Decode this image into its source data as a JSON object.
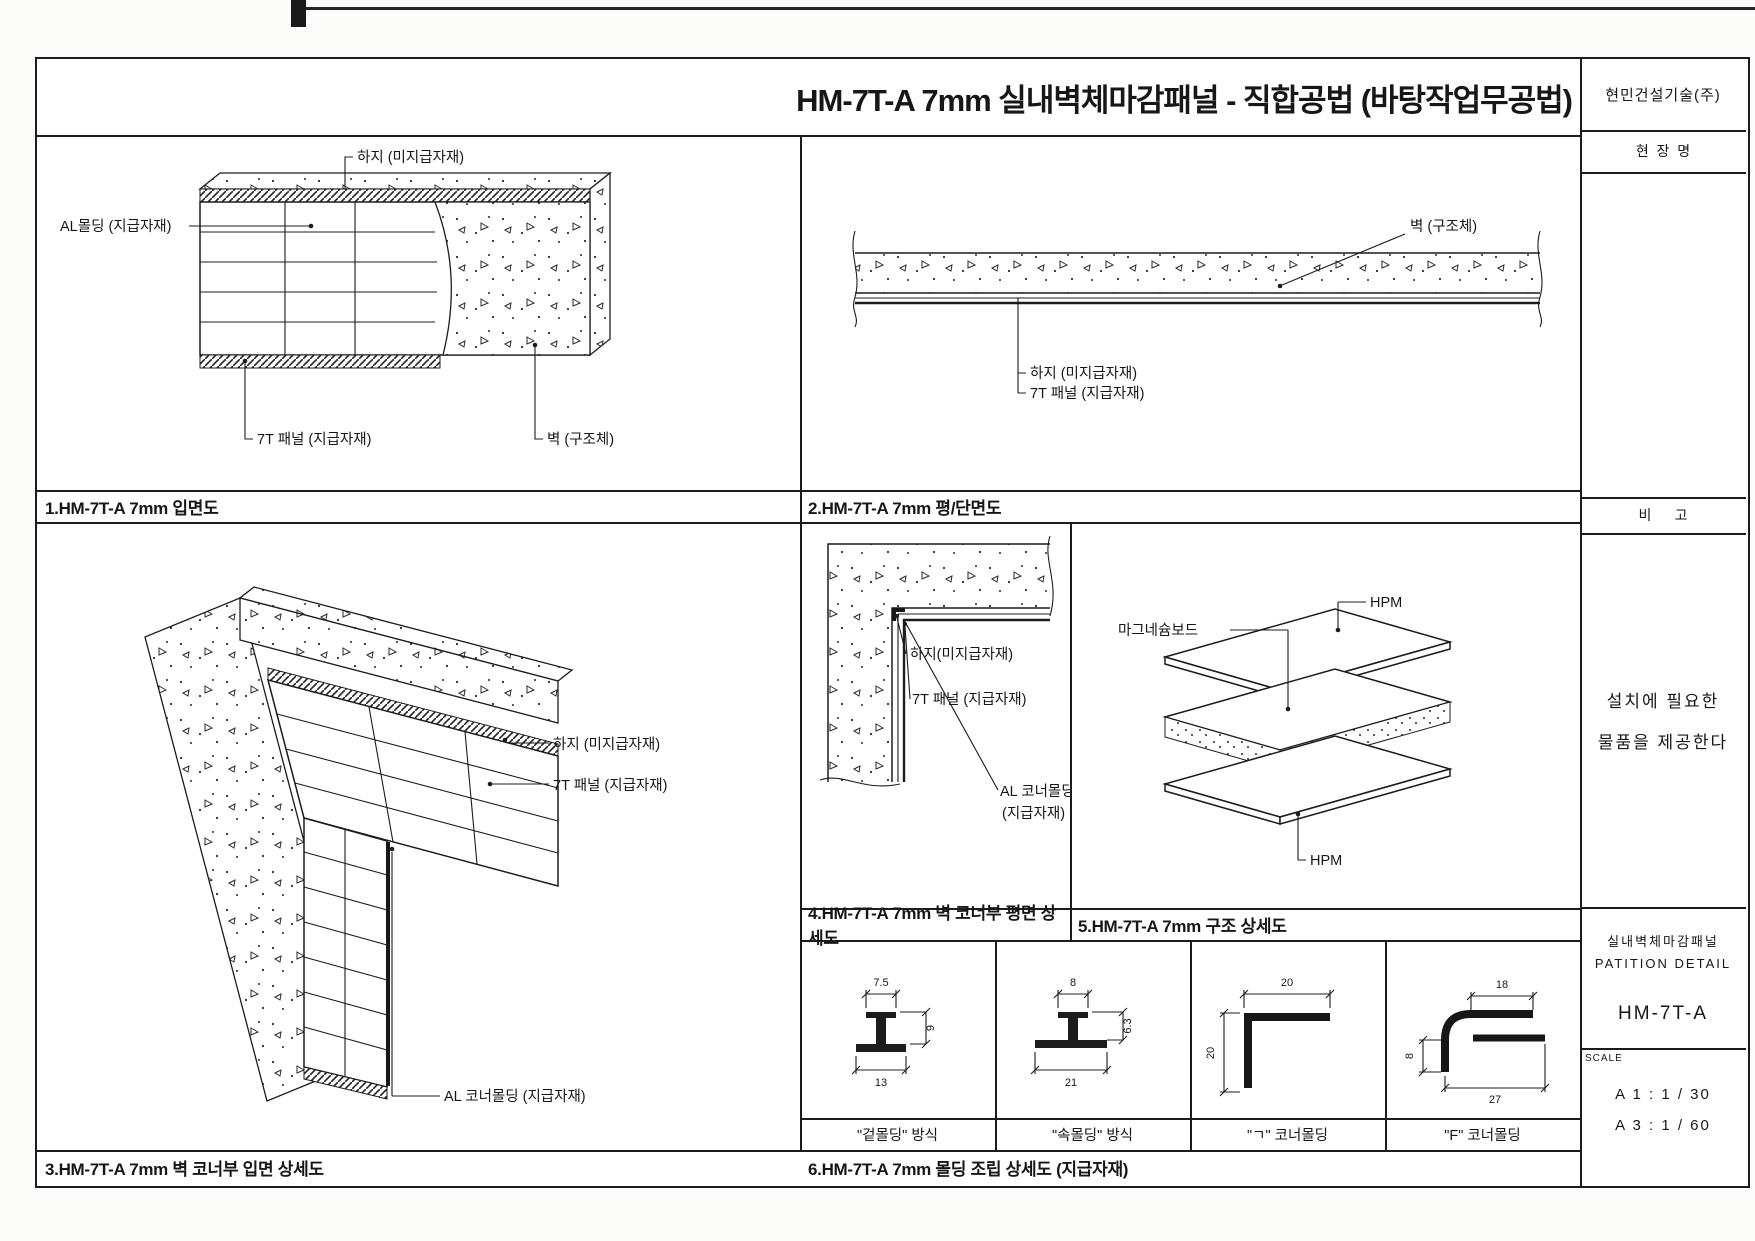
{
  "sheet": {
    "title": "HM-7T-A 7mm 실내벽체마감패널 - 직합공법 (바탕작업무공법)",
    "company": "현민건설기술(주)",
    "site_label": "현  장  명",
    "remark_label": "비      고",
    "note": {
      "line1": "설치에 필요한",
      "line2": "물품을 제공한다"
    },
    "titleblock": {
      "name_kr": "실내벽체마감패널",
      "name_en": "PATITION DETAIL",
      "code": "HM-7T-A",
      "scale_label": "SCALE",
      "scale_a1": "A 1 : 1 / 30",
      "scale_a3": "A 3 : 1 / 60"
    }
  },
  "panel1": {
    "caption": "1.HM-7T-A 7mm 입면도",
    "label_base": "하지 (미지급자재)",
    "label_molding": "AL몰딩 (지급자재)",
    "label_panel": "7T 패널 (지급자재)",
    "label_wall": "벽 (구조체)"
  },
  "panel2": {
    "caption": "2.HM-7T-A 7mm 평/단면도",
    "label_wall": "벽 (구조체)",
    "label_base": "하지 (미지급자재)",
    "label_panel": "7T 패널 (지급자재)"
  },
  "panel3": {
    "caption": "3.HM-7T-A 7mm 벽 코너부 입면 상세도",
    "label_base": "하지 (미지급자재)",
    "label_panel": "7T 패널 (지급자재)",
    "label_corner": "AL 코너몰딩 (지급자재)"
  },
  "panel4": {
    "caption": "4.HM-7T-A 7mm 벽 코너부 평면 상세도",
    "label_base": "하지(미지급자재)",
    "label_panel": "7T 패널 (지급자재)",
    "label_corner_1": "AL 코너몰딩",
    "label_corner_2": "(지급자재)"
  },
  "panel5": {
    "caption": "5.HM-7T-A 7mm 구조 상세도",
    "label_core": "마그네슘보드",
    "label_hpm_top": "HPM",
    "label_hpm_bottom": "HPM"
  },
  "panel6": {
    "caption": "6.HM-7T-A 7mm 몰딩 조립 상세도 (지급자재)",
    "cells": [
      {
        "name": "\"겉몰딩\" 방식",
        "dim_top": "7.5",
        "dim_height": "9",
        "dim_bottom": "13"
      },
      {
        "name": "\"속몰딩\" 방식",
        "dim_top": "8",
        "dim_height": "6.3",
        "dim_bottom": "21"
      },
      {
        "name": "\"ㄱ\" 코너몰딩",
        "dim_top": "20",
        "dim_side": "20"
      },
      {
        "name": "\"F\" 코너몰딩",
        "dim_top": "18",
        "dim_side": "8",
        "dim_bottom": "27"
      }
    ]
  }
}
